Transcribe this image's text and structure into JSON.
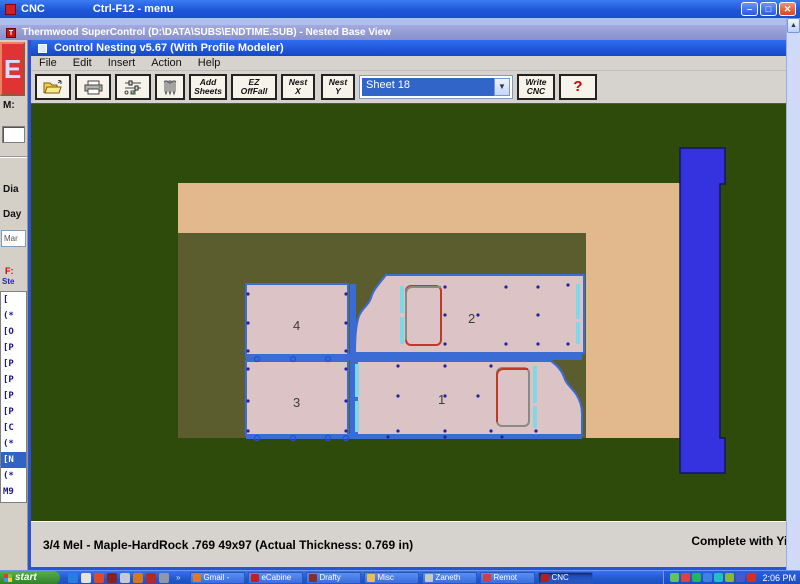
{
  "window": {
    "outer": {
      "title": "CNC",
      "subtitle": "Ctrl-F12 - menu"
    },
    "supercontrol_title": "Thermwood SuperControl (D:\\DATA\\SUBS\\ENDTIME.SUB) - Nested Base View",
    "nesting_title": "Control Nesting v5.67 (With Profile Modeler)",
    "controls": {
      "minimize": "–",
      "maximize": "□",
      "close": "✕"
    }
  },
  "menu": {
    "items": [
      "File",
      "Edit",
      "Insert",
      "Action",
      "Help"
    ]
  },
  "toolbar": {
    "add_sheets": [
      "Add",
      "Sheets"
    ],
    "ez_offfall": [
      "EZ",
      "OffFall"
    ],
    "nest_x": [
      "Nest",
      "X"
    ],
    "nest_y": [
      "Nest",
      "Y"
    ],
    "write_cnc": [
      "Write",
      "CNC"
    ],
    "help": "?",
    "sheet_select": "Sheet 18"
  },
  "left_panel": {
    "e_label": "E",
    "m_label": "M:",
    "dia_label": "Dia",
    "day_label": "Day",
    "combo_value": "Mar",
    "f_label": "F:",
    "ste_label": "Ste",
    "list_items": [
      "[",
      "(*",
      "[O",
      "[P",
      "[P",
      "[P",
      "[P",
      "[P",
      "[C",
      "(*",
      "[N",
      "(*",
      "M9"
    ],
    "selected_item": "[N"
  },
  "nest": {
    "part_labels": {
      "p1": "1",
      "p2": "2",
      "p3": "3",
      "p4": "4"
    },
    "sheet_count_selected": "Sheet 18"
  },
  "statusbar": {
    "material": "3/4 Mel - Maple-HardRock .769 49x97 (Actual Thickness: 0.769 in)",
    "right": "Complete with Yie"
  },
  "taskbar": {
    "start": "start",
    "more_chevron": "»",
    "tasks": [
      {
        "label": "Gmail -"
      },
      {
        "label": "eCabine"
      },
      {
        "label": "Drafty"
      },
      {
        "label": "Misc"
      },
      {
        "label": "Zaneth"
      },
      {
        "label": "Remot"
      },
      {
        "label": "CNC"
      }
    ],
    "active_task": "CNC",
    "clock": "2:06 PM"
  },
  "colors": {
    "titlebar_blue": "#1c55d6",
    "inactive_lavender": "#8890cc",
    "canvas_green": "#2e4b0c",
    "sheet_remainder_olive": "#5c5d2f",
    "sheet_tan": "#e2b88d",
    "part_pink": "#dcc3c6",
    "part_border_blue": "#3a6cd4",
    "dado_cyan": "#7fd8e8",
    "rail_blue": "#3533e0",
    "cutout_red": "#c03828",
    "cutout_gray": "#8a8a84",
    "hole_navy": "#23239a"
  }
}
